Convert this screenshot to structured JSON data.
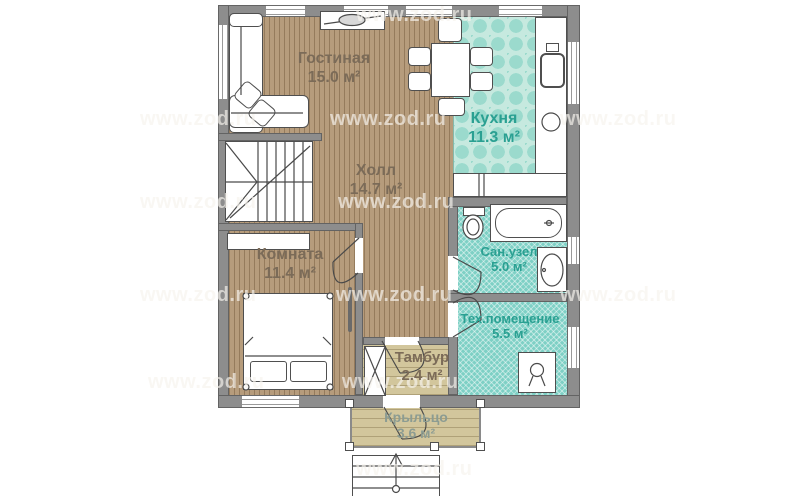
{
  "plan": {
    "type": "floor-plan",
    "watermark": {
      "text": "www.zod.ru"
    },
    "rooms": {
      "living": {
        "name": "Гостиная",
        "area": "15.0 м²"
      },
      "kitchen": {
        "name": "Кухня",
        "area": "11.3 м²"
      },
      "hall": {
        "name": "Холл",
        "area": "14.7 м²"
      },
      "bedroom": {
        "name": "Комната",
        "area": "11.4 м²"
      },
      "bathroom": {
        "name": "Сан.узел",
        "area": "5.0 м²"
      },
      "utility": {
        "name": "Тех.помещение",
        "area": "5.5 м²"
      },
      "vestibule": {
        "name": "Тамбур",
        "area": "2.4 м²"
      },
      "porch": {
        "name": "Крыльцо",
        "area": "3.6 м²"
      }
    }
  },
  "colors": {
    "wood": "#b69c7c",
    "kitchen-tile": "#c6e9df",
    "kitchen-pattern": "#9bdacd",
    "wet-tile": "#7ed0c5",
    "plank": "#d2c69c",
    "wall": "#8d8d8d",
    "label-brown": "#7b6b58",
    "label-teal": "#2aa092",
    "label-porch": "#8c9c92"
  }
}
